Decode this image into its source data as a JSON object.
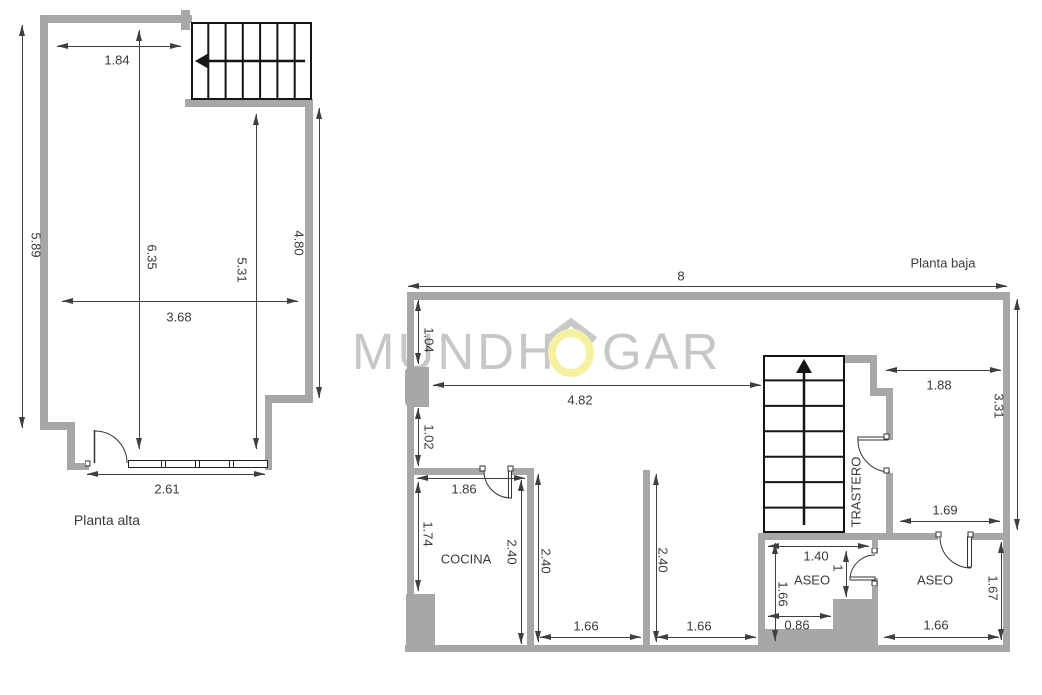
{
  "watermark": {
    "full": "MUNDHOGAR",
    "prefix": "MUNDH",
    "suffix": "GAR"
  },
  "colors": {
    "wall": "#a7a7a7",
    "dim_line": "#3f3f3f",
    "text": "#3a3a3a",
    "logo_gray": "#c7c7c7",
    "logo_yellow": "#f5f1a1",
    "stairs": "#151515"
  },
  "planta_alta": {
    "title": "Planta alta",
    "dims": {
      "top": "1.84",
      "left": "5.89",
      "middle": "6.35",
      "inner_right": "5.31",
      "right": "4.80",
      "width": "3.68",
      "bottom": "2.61"
    }
  },
  "planta_baja": {
    "title": "Planta baja",
    "rooms": {
      "cocina": "COCINA",
      "trastero": "TRASTERO",
      "aseo_left": "ASEO",
      "aseo_right": "ASEO"
    },
    "dims": {
      "total_top": "8",
      "left_upper": "1.04",
      "hall_width": "4.82",
      "left_lower": "1.02",
      "cocina_width": "1.86",
      "cocina_left": "1.74",
      "cocina_depth": "2.40",
      "room2_depth": "2.40",
      "room2_width": "1.66",
      "room3_depth": "2.40",
      "room3_width": "1.66",
      "nook_width": "1.88",
      "right_upper": "3.31",
      "aseo_r_top": "1.69",
      "aseo_l_top": "1.40",
      "aseo_l_door": "1",
      "aseo_l_left": "1.66",
      "aseo_l_step": "0.86",
      "aseo_r_right": "1.67",
      "aseo_r_bottom": "1.66"
    }
  }
}
